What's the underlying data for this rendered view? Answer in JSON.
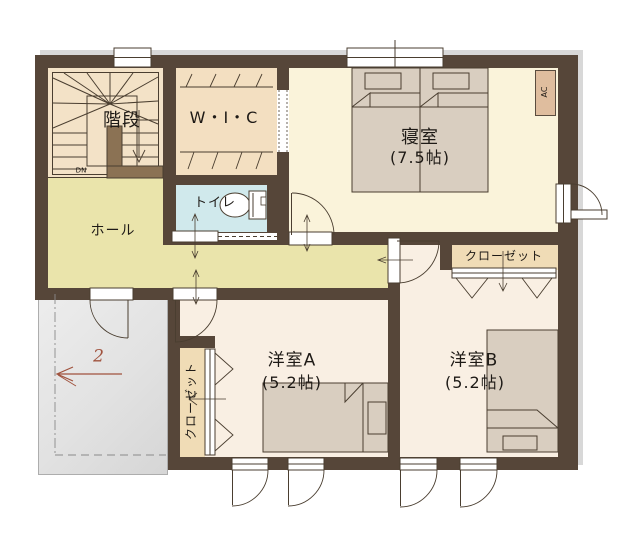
{
  "rooms": {
    "stairs": {
      "label": "階段",
      "down_label": "DN"
    },
    "wic": {
      "label": "W・I・C"
    },
    "bedroom": {
      "label": "寝室",
      "size": "(7.5帖)"
    },
    "toilet": {
      "label": "トイレ"
    },
    "hall": {
      "label": "ホール"
    },
    "room_a": {
      "label": "洋室A",
      "size": "(5.2帖)"
    },
    "room_b": {
      "label": "洋室B",
      "size": "(5.2帖)"
    },
    "closet_a": {
      "label": "クローゼット"
    },
    "closet_b": {
      "label": "クローゼット"
    }
  },
  "labels": {
    "ac_unit": "AC",
    "floor_number": "2"
  },
  "icons": {
    "staircase-icon": "U-shaped stair with winder fan, treads and DN arrow",
    "toilet-icon": "toilet bowl ellipse with tank rectangle",
    "twin-beds-icon": "two single beds with pillows and folded covers",
    "bed-icon-room-a": "single bed, pillow at right",
    "bed-icon-room-b": "single bed, pillow at bottom",
    "door-arc-icon": "quarter-circle swing doors",
    "sliding-door-icon": "toilet sliding door with dashed track",
    "folding-door-icon": "closet folding doors shown as chevrons",
    "window-icon": "double-line windows, casements with swing arcs",
    "flow-arrow-icon": "thin double-headed circulation arrows",
    "floor-arrow-icon": "red arrow with floor number 2 on balcony"
  },
  "colors": {
    "wall": "#564639",
    "wall_divider": "#8b7254",
    "stairs_floor": "#f3e2c7",
    "wic_floor": "#f3dfc1",
    "bedroom_floor": "#faf3da",
    "toilet_floor": "#d0e9ec",
    "hall_floor": "#eae4ab",
    "western_room_floor": "#f9efe3",
    "closet_floor": "#f0dcb6",
    "bed_fill": "#d9cec0",
    "ac_fill": "#dfbd9e",
    "balcony_fill": "#e5e5e5",
    "line": "#4a3e30",
    "floor_arrow": "#a0523d"
  }
}
